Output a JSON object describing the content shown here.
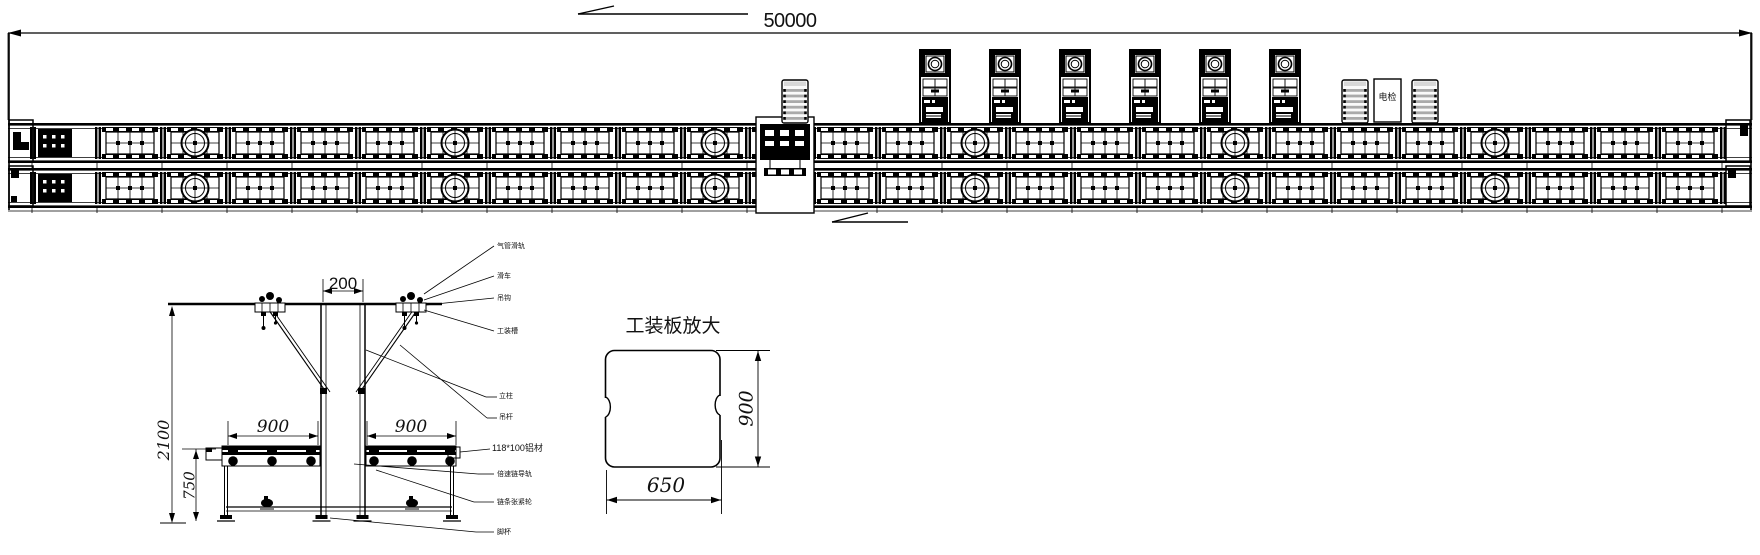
{
  "drawing": {
    "plan": {
      "overall_dim": "50000",
      "electric_check_label": "电检"
    },
    "cross_section": {
      "dim_width_top": "200",
      "dim_span_left": "900",
      "dim_span_right": "900",
      "dim_height_total": "2100",
      "dim_height_conveyor": "750",
      "callouts": [
        "气管滑轨",
        "滑车",
        "吊钩",
        "工装槽",
        "立柱",
        "吊杆",
        "118*100铝材",
        "倍速链导轨",
        "链条张紧轮",
        "脚杯"
      ]
    },
    "detail": {
      "title": "工装板放大",
      "dim_height": "900",
      "dim_width": "650"
    }
  }
}
